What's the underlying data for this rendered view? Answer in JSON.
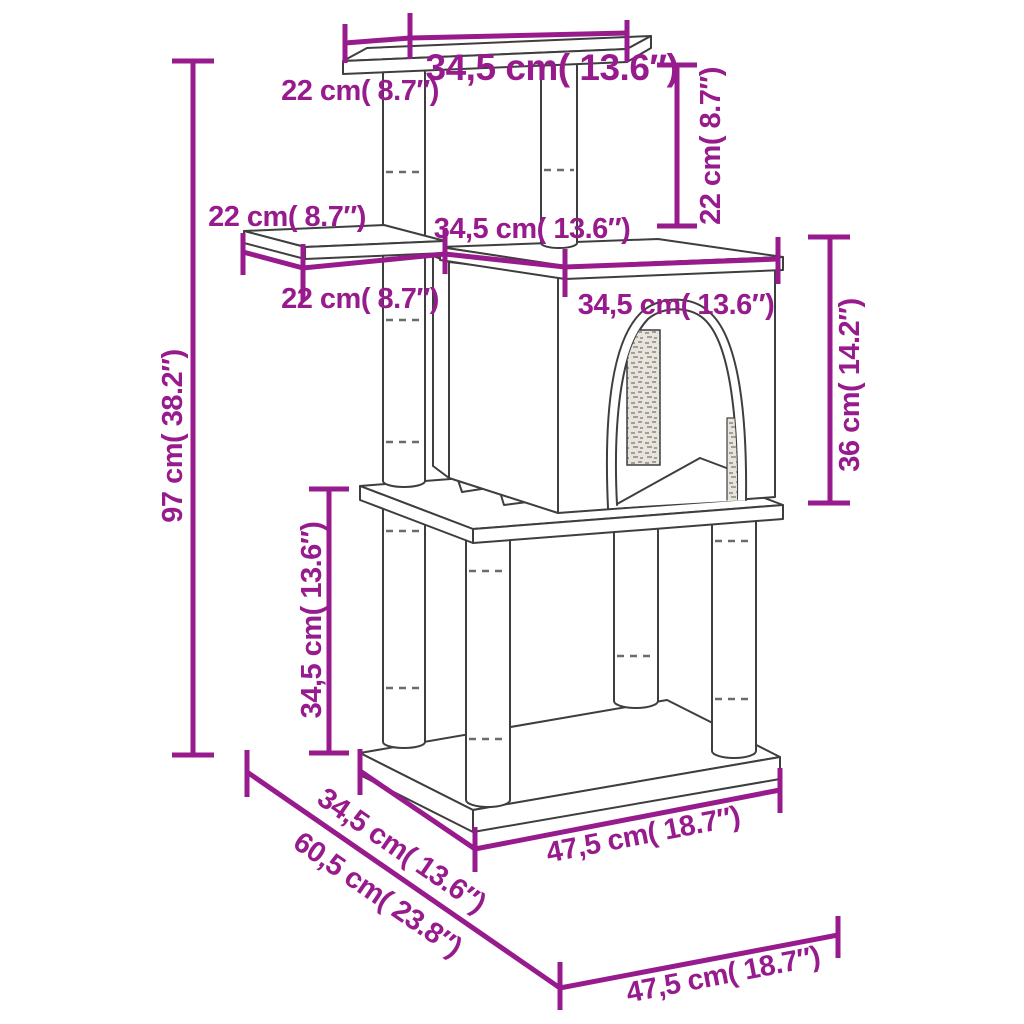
{
  "colors": {
    "dimension": "#971B8C",
    "outline": "#3E3E3E",
    "background": "#FFFFFF"
  },
  "dims": {
    "top_platform_depth": {
      "text": "22 cm( 8.7″)"
    },
    "top_platform_width": {
      "text": "34,5 cm( 13.6″)"
    },
    "upper_post_height": {
      "text": "22 cm( 8.7″)"
    },
    "side_platform_depth": {
      "text": "22 cm( 8.7″)"
    },
    "roof_depth": {
      "text": "34,5 cm( 13.6″)"
    },
    "side_platform_width": {
      "text": "22 cm( 8.7″)"
    },
    "roof_width": {
      "text": "34,5 cm( 13.6″)"
    },
    "condo_height": {
      "text": "36 cm( 14.2″)"
    },
    "total_height": {
      "text": "97 cm( 38.2″)"
    },
    "lower_section_height": {
      "text": "34,5 cm( 13.6″)"
    },
    "base_platform_depth": {
      "text": "34,5 cm( 13.6″)"
    },
    "footprint_depth": {
      "text": "60,5 cm( 23.8″)"
    },
    "base_platform_width": {
      "text": "47,5 cm( 18.7″)"
    },
    "footprint_width": {
      "text": "47,5 cm( 18.7″)"
    }
  }
}
